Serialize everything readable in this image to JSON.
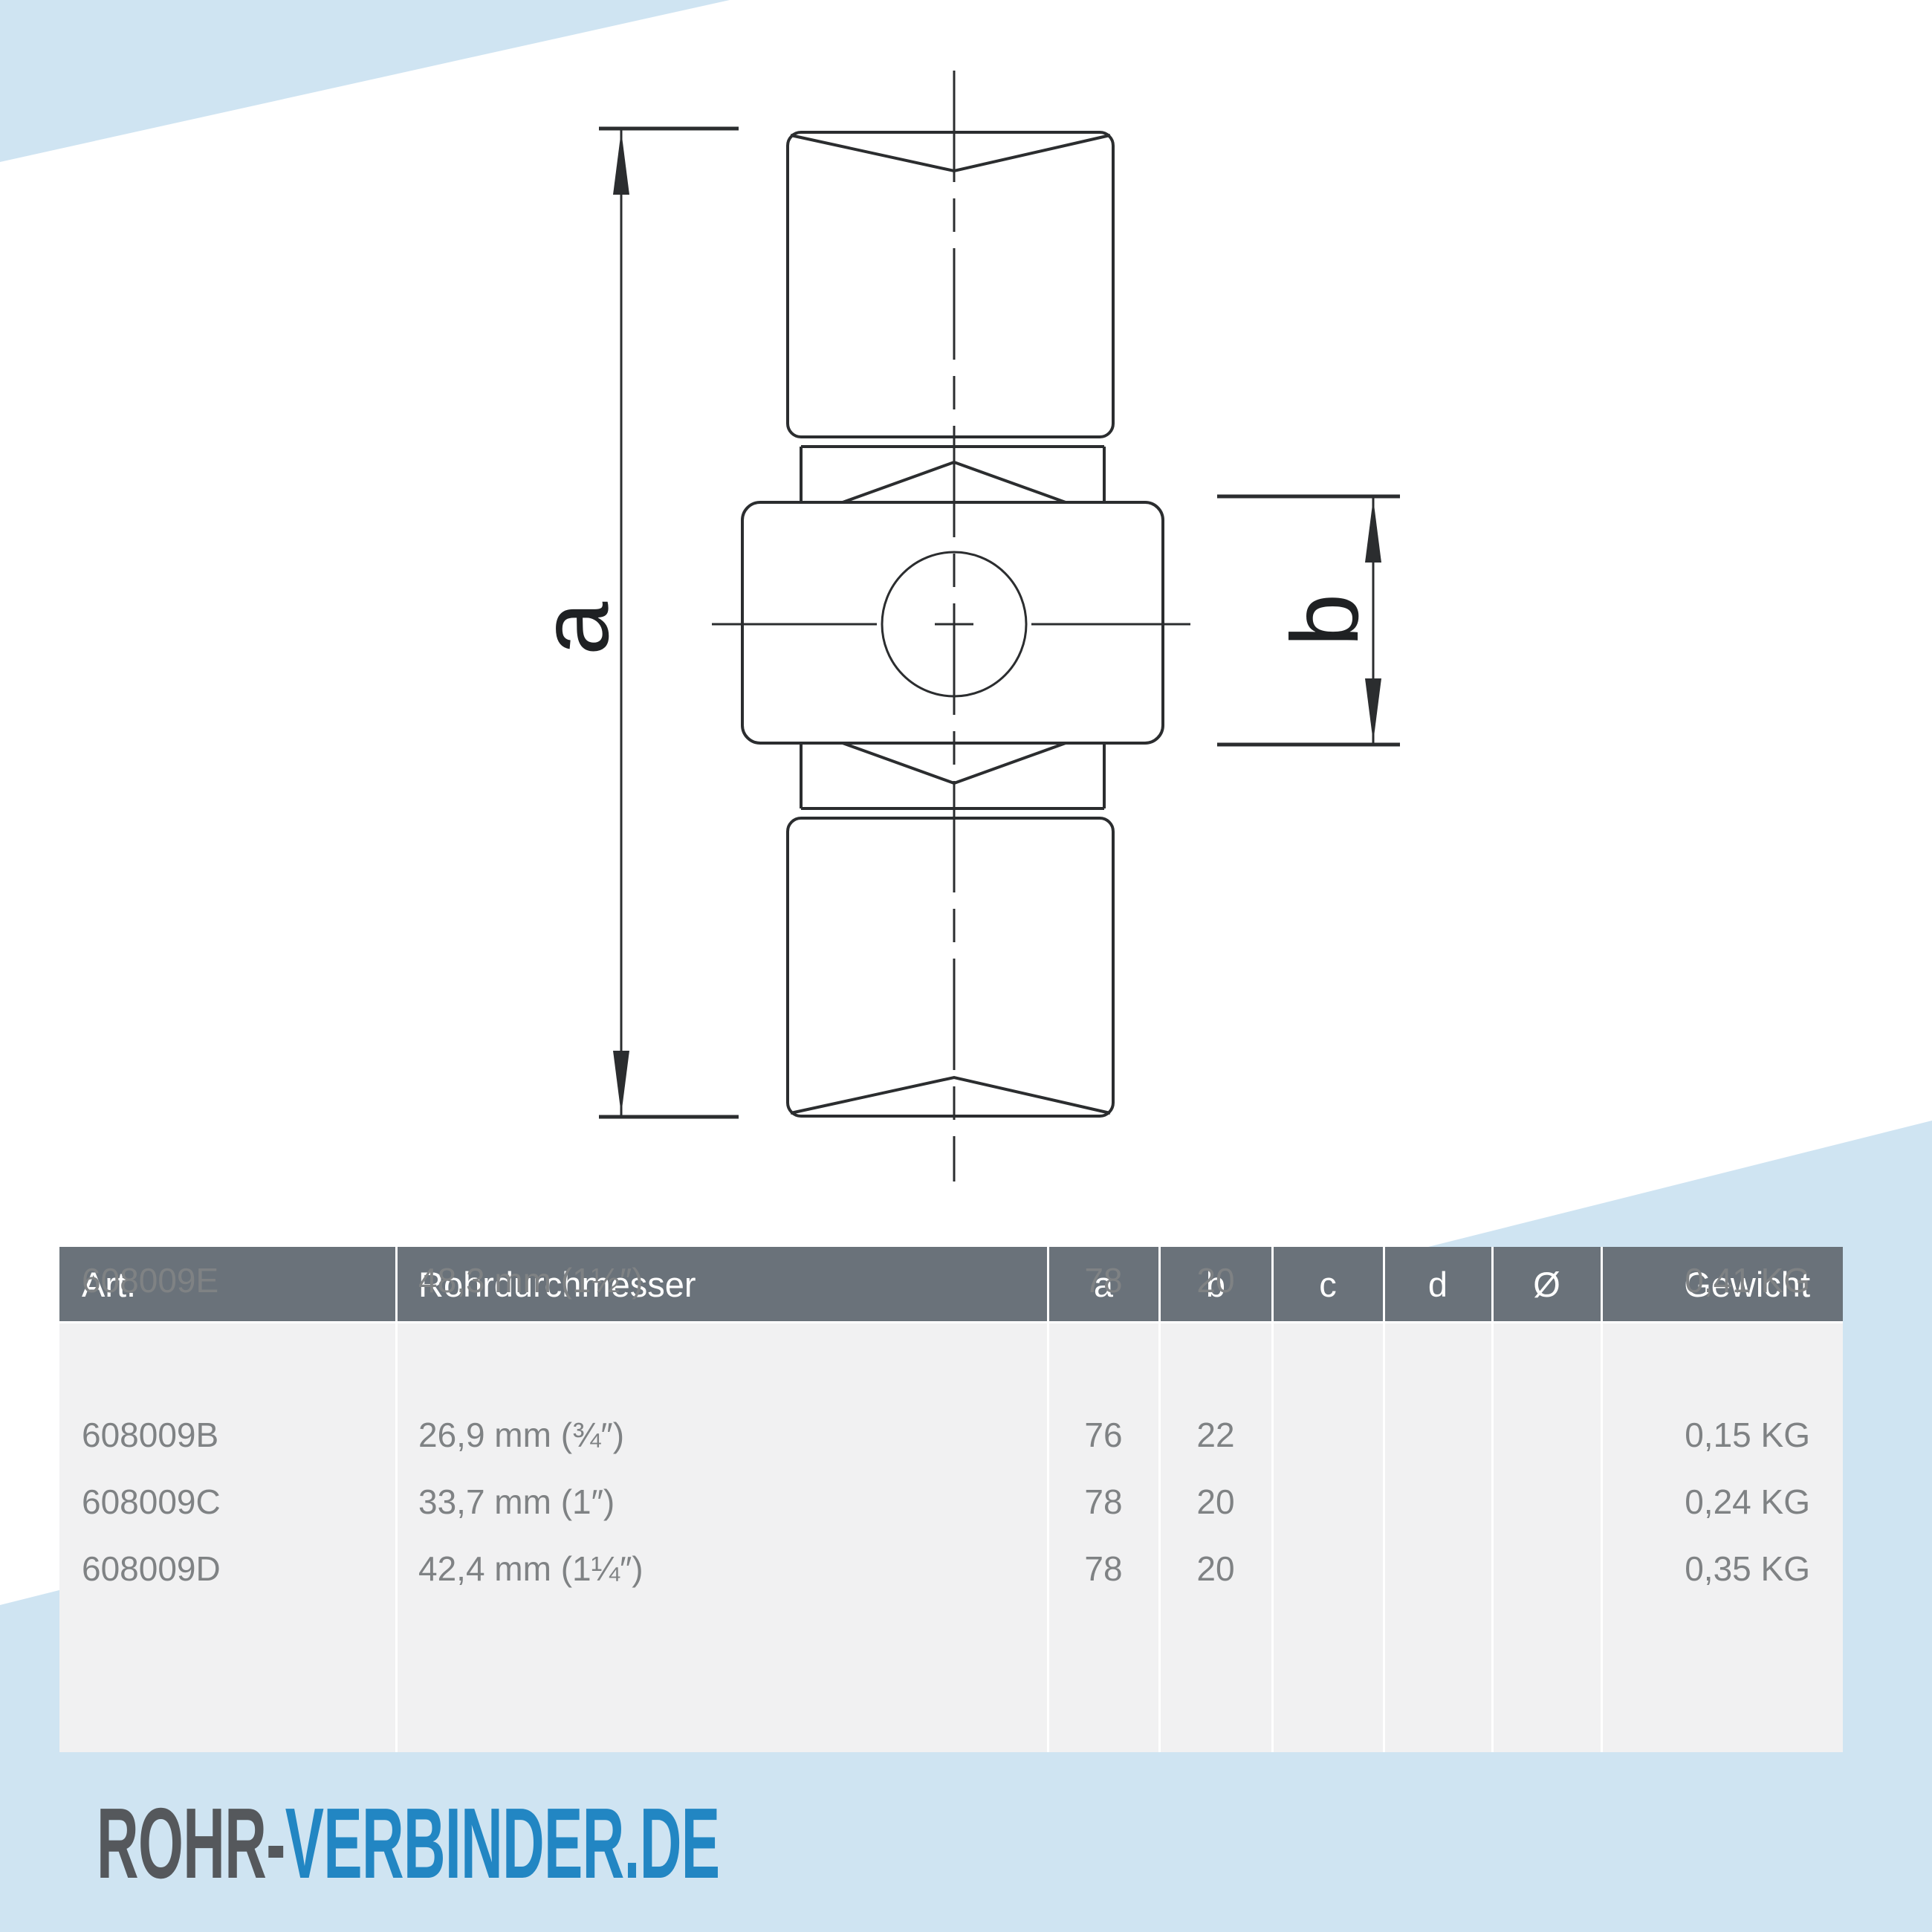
{
  "colors": {
    "accent_light_blue": "#cfe4f2",
    "table_header_bg": "#6a727a",
    "table_body_bg": "#f1f1f2",
    "table_text": "#7f8284",
    "drawing_line": "#2b2d2f",
    "logo_gray": "#55585c",
    "logo_blue": "#2286c3"
  },
  "drawing": {
    "label_a": "a",
    "label_b": "b"
  },
  "table": {
    "headers": [
      "Art.",
      "Rohrdurchmesser",
      "a",
      "b",
      "c",
      "d",
      "Ø",
      "Gewicht"
    ],
    "rows": [
      {
        "art": "608009B",
        "diameter": "26,9 mm (¾″)",
        "a": "76",
        "b": "22",
        "c": "",
        "d": "",
        "o": "",
        "weight": "0,15 KG"
      },
      {
        "art": "608009C",
        "diameter": "33,7 mm (1″)",
        "a": "78",
        "b": "20",
        "c": "",
        "d": "",
        "o": "",
        "weight": "0,24 KG"
      },
      {
        "art": "608009D",
        "diameter": "42,4 mm (1¼″)",
        "a": "78",
        "b": "20",
        "c": "",
        "d": "",
        "o": "",
        "weight": "0,35 KG"
      },
      {
        "art": "608009E",
        "diameter": "48,3 mm (1½″)",
        "a": "78",
        "b": "20",
        "c": "",
        "d": "",
        "o": "",
        "weight": "0,41 KG"
      }
    ]
  },
  "logo": {
    "part1": "ROHR-",
    "part2": "VERBINDER.DE"
  }
}
